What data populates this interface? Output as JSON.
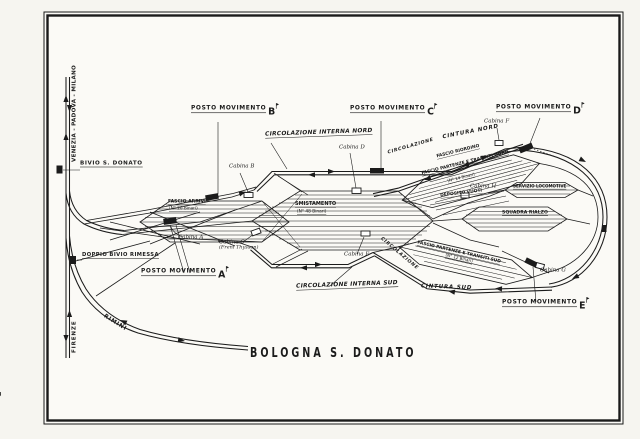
{
  "page_number": "3",
  "title": "BOLOGNA  S. DONATO",
  "junctions": {
    "bivio": "BIVIO S. DONATO",
    "doppio": "DOPPIO BIVIO RIMESSA"
  },
  "destinations": {
    "north": "VENEZIA - PADOVA - MILANO",
    "south": "FIRENZE",
    "rimini": "RIMINI"
  },
  "pm": {
    "a": {
      "text": "POSTO MOVIMENTO",
      "letter": "A"
    },
    "b": {
      "text": "POSTO MOVIMENTO",
      "letter": "B"
    },
    "c": {
      "text": "POSTO MOVIMENTO",
      "letter": "C"
    },
    "d": {
      "text": "POSTO MOVIMENTO",
      "letter": "D"
    },
    "e": {
      "text": "POSTO MOVIMENTO",
      "letter": "E"
    }
  },
  "cab": {
    "a": "Cabina A",
    "b": "Cabina B",
    "c": "Cabina C",
    "c_note": "(Freni Thyssen)",
    "d": "Cabina D",
    "e": "Cabina E",
    "f": "Cabina F",
    "g": "Cabina G",
    "h": "Cabina H"
  },
  "routes": {
    "circ_interna_nord": "CIRCOLAZIONE INTERNA NORD",
    "circ_interna_sud": "CIRCOLAZIONE INTERNA SUD",
    "cintura_nord": "CINTURA NORD",
    "cintura_sud": "CINTURA SUD",
    "circolazione_nord": "CIRCOLAZIONE",
    "circolazione_sud": "CIRCOLAZIONE"
  },
  "yards": {
    "arrivi": {
      "name": "FASCIO ARRIVI",
      "tracks": "(N° 20 Binari)"
    },
    "smistamento": {
      "name": "SMISTAMENTO",
      "tracks": "(N° 48 Binari)"
    },
    "riordino": {
      "name": "FASCIO RIORDINO"
    },
    "partenze_nord": {
      "name": "FASCIO PARTENZE E TRANSITI NORD",
      "tracks": "(N° 14 Binari)"
    },
    "deposito_vuoti": {
      "name": "DEPOSITO VUOTI"
    },
    "servizio_locomotive": {
      "name": "SERVIZIO LOCOMOTIVE"
    },
    "squadra_rialzo": {
      "name": "SQUADRA RIALZO"
    },
    "partenze_sud": {
      "name": "FASCIO PARTENZE E TRANSITI SUD",
      "tracks": "(N° 12 Binari)"
    }
  }
}
